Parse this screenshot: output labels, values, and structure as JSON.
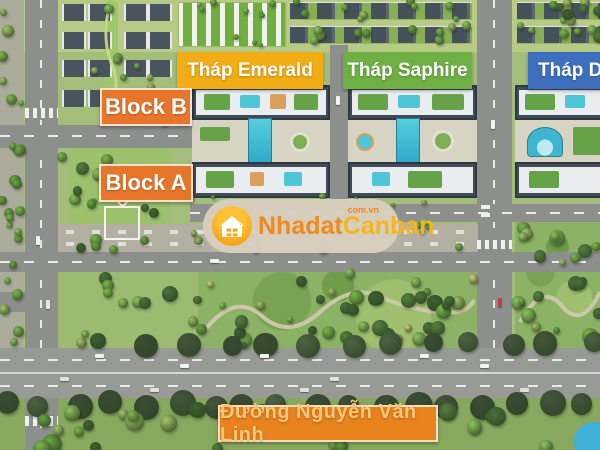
{
  "labels": {
    "tower_emerald": "Tháp Emerald",
    "tower_saphire": "Tháp Saphire",
    "tower_diamond": "Tháp Di",
    "block_b": "Block B",
    "block_a": "Block A",
    "street": "Đường Nguyễn Văn Linh"
  },
  "watermark": {
    "brand_part1": "Nhadat",
    "brand_part2": "Canban",
    "domain": "com.vn"
  },
  "colors": {
    "emerald_bg": "#F2AC15",
    "saphire_bg": "#6FB045",
    "diamond_bg": "#3E6FBE",
    "block_bg": "#E8762A",
    "street_bg": "#E8821C",
    "street_text": "#FFC87A",
    "label_text": "#FFFFFF",
    "watermark_brand1": "#EF8A1E",
    "watermark_brand2": "#F6B51D",
    "watermark_domain": "#EF8A1E"
  }
}
